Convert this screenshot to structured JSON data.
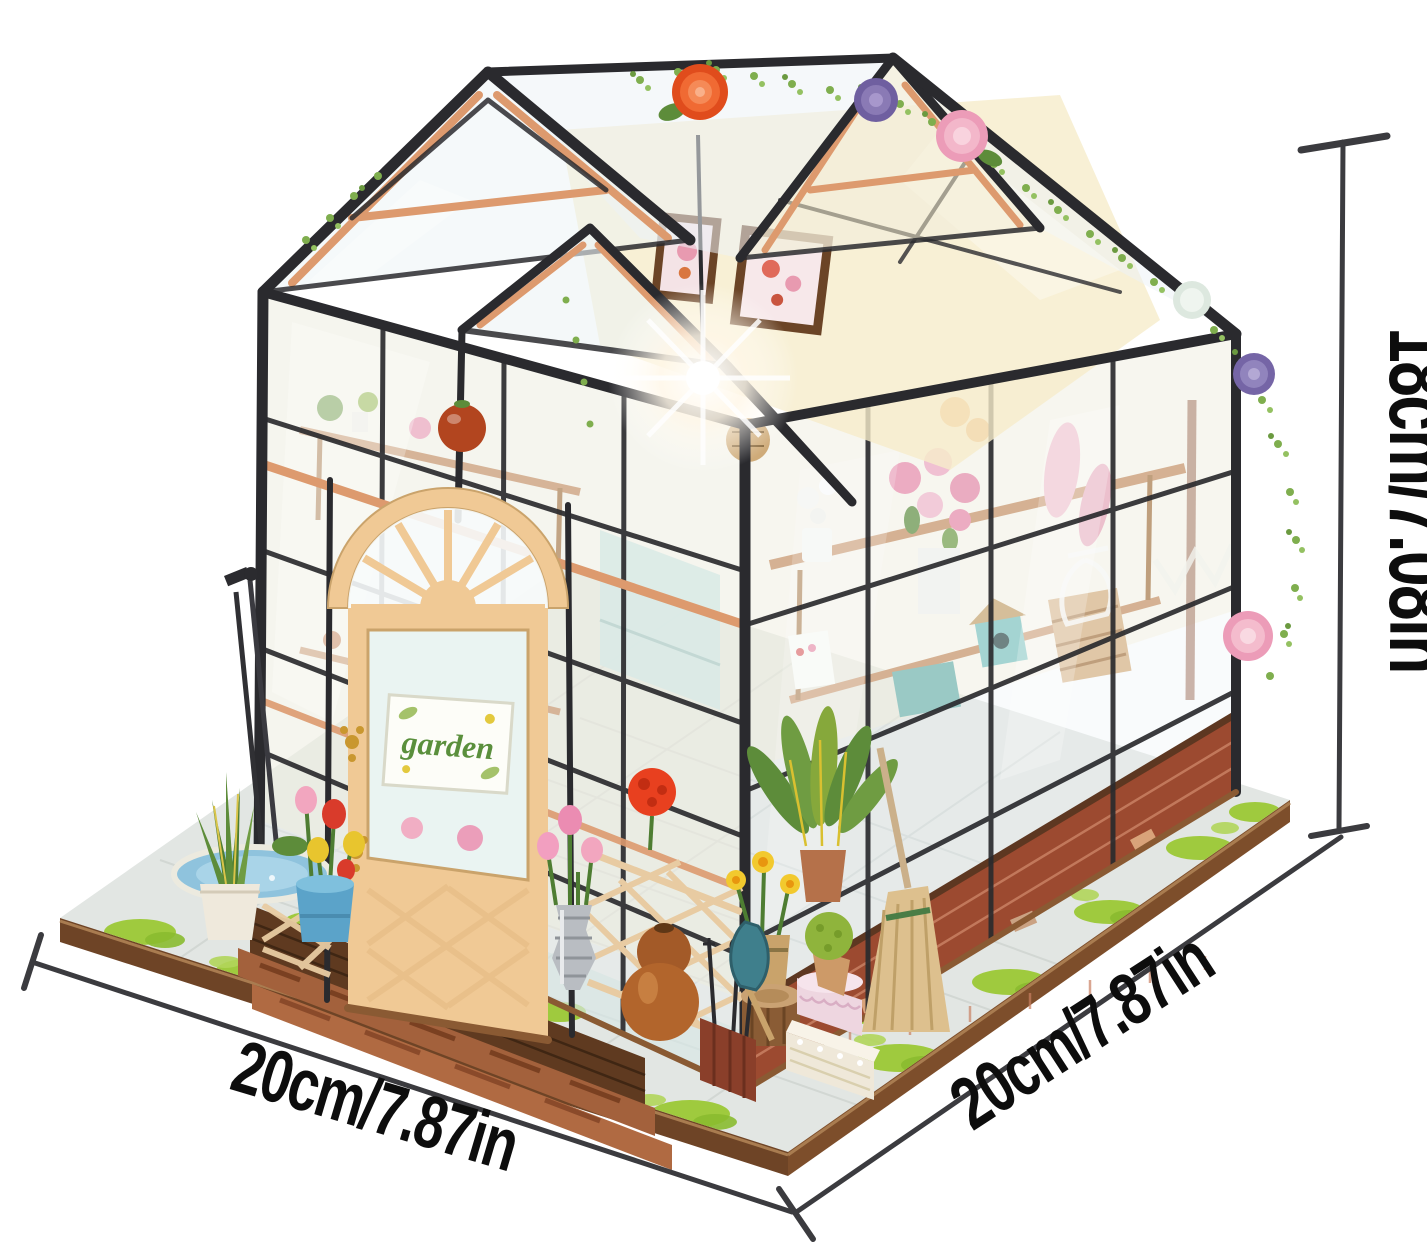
{
  "page": {
    "width_px": 1427,
    "height_px": 1246,
    "background": "#ffffff",
    "description": "Product photo of a DIY miniature greenhouse dollhouse kit with printed dimension annotations"
  },
  "annotations": {
    "height": {
      "label": "18cm/7.08in"
    },
    "width": {
      "label": "20cm/7.87in"
    },
    "depth": {
      "label": "20cm/7.87in"
    }
  },
  "door_sign": {
    "text": "garden"
  },
  "palette": {
    "bg": "#ffffff",
    "ink": "#0d0d0d",
    "dim_line": "#3b3b3f",
    "frame_black": "#2a2a2e",
    "wood_mid": "#dd9a6e",
    "wood_dark": "#8a5a33",
    "door_wood": "#f0c995",
    "glass_tint": "#ecf3f5",
    "interior_cream": "#f6eccb",
    "grass_green": "#9fca3e",
    "vine_green": "#7fae4e",
    "brick_red": "#9c4a30",
    "rose_orange": "#ef5a26",
    "rose_purple": "#7b68a8",
    "rose_pink": "#f2a6bf",
    "pot_blue": "#5ba3c9",
    "metal_silver": "#b9bdc2",
    "sign_green": "#5a8f3c"
  }
}
